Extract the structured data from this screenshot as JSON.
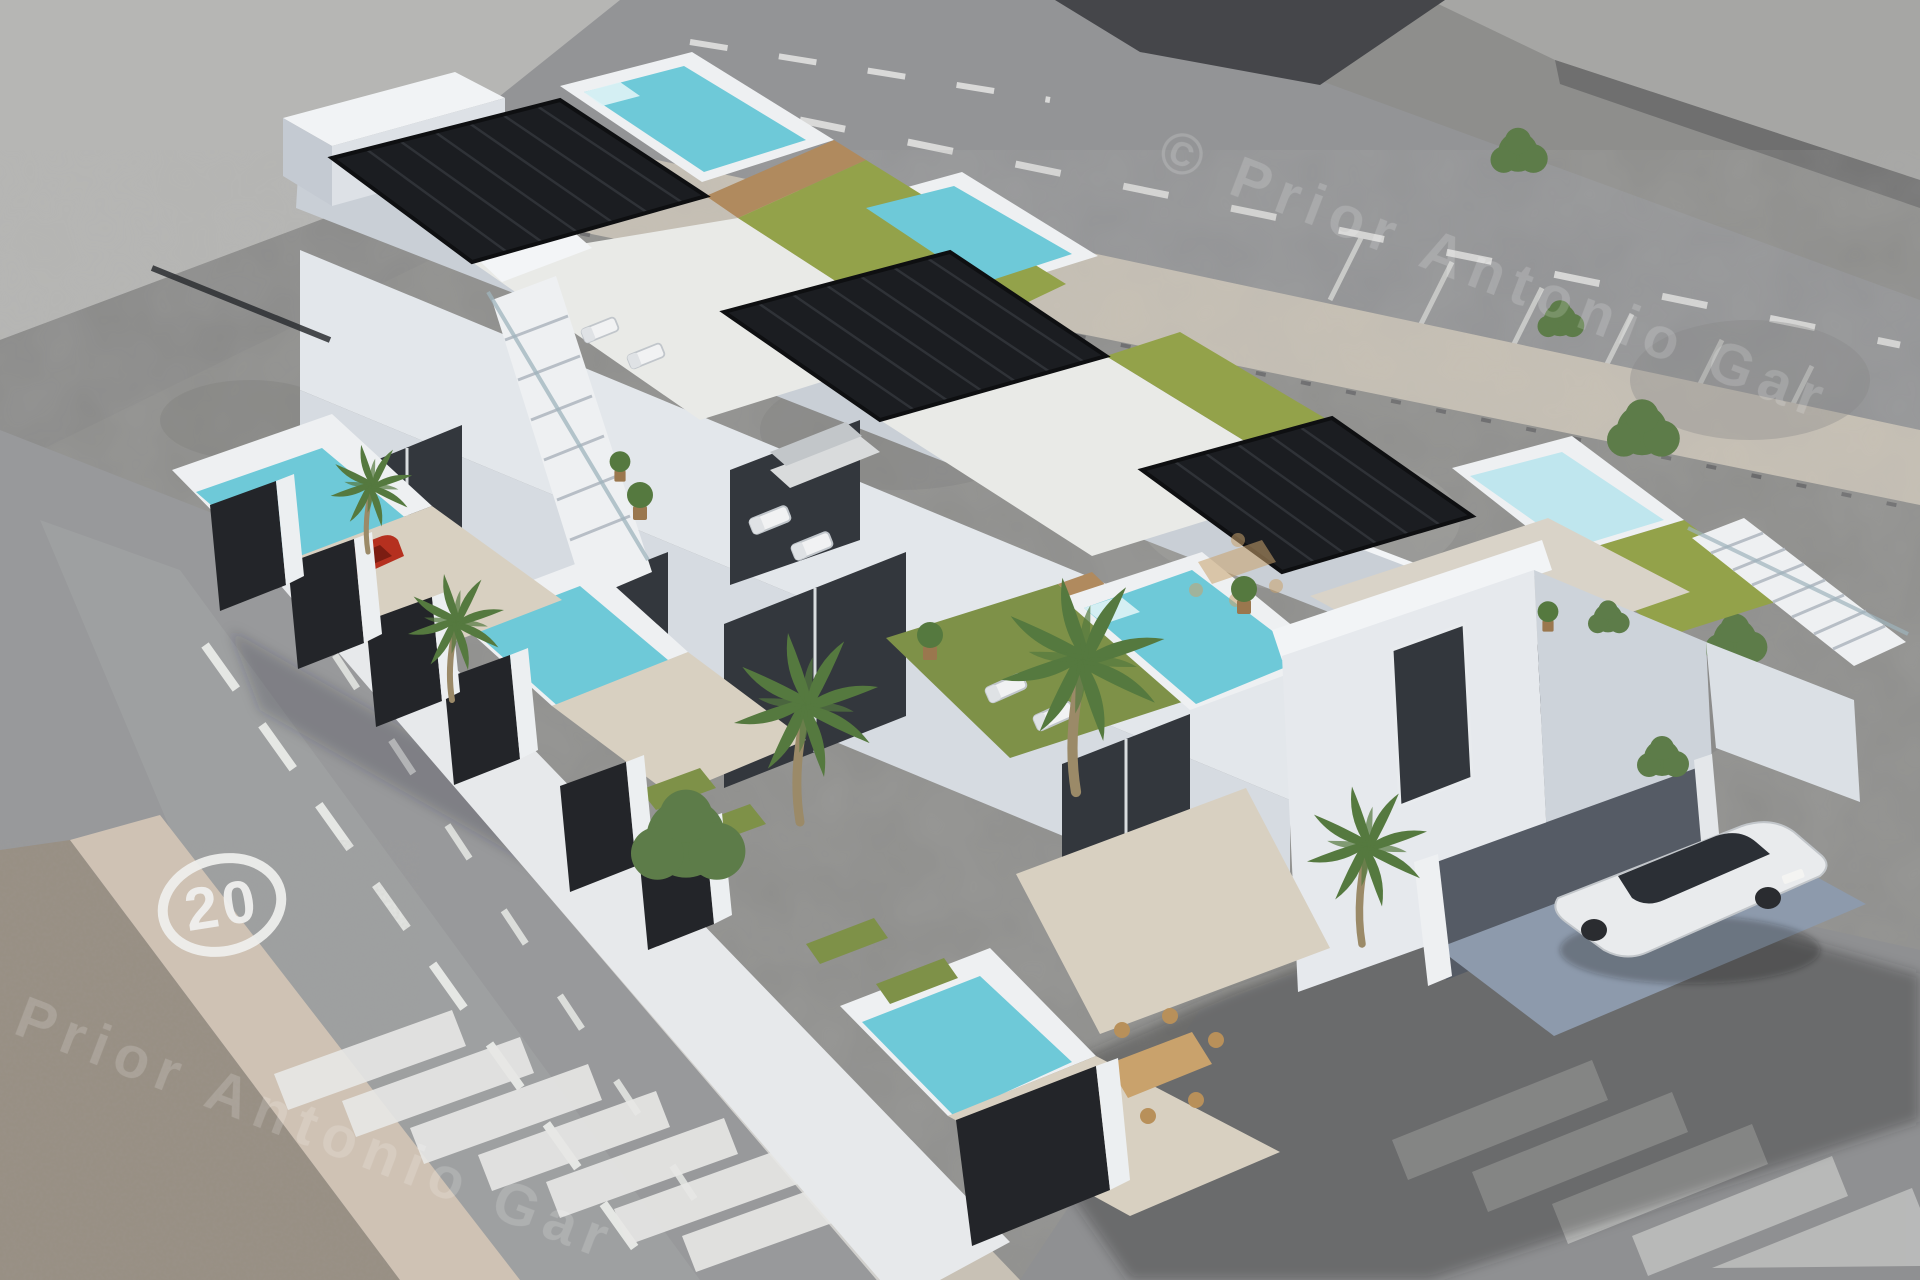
{
  "meta": {
    "description": "Aerial 3D architectural render of a modern white residential row building with black louvered pergolas, rooftop pools, artificial turf roof strips, private garden pools, palm trees, a carport with a white car and a red car behind a black fence, photomontaged onto a grayscale aerial photo of a street corner with lane dashes, pedestrian crossings and a painted 20 km/h speed marking."
  },
  "watermark": {
    "text": "© Prior Antonio Gar",
    "opacity": 0.17
  },
  "road": {
    "speed_limit_marking": "20"
  },
  "palette": {
    "lot_gray": "#8e8e8c",
    "top_road_gray": "#939496",
    "street_gray": "#98999b",
    "sidewalk_beige": "#c8c1b5",
    "rubble_tan": "#988f83",
    "warehouse_gray": "#a6a6a4",
    "dark_roof": "#45464a",
    "building_white": "#eef0f3",
    "building_shade": "#c9cfd6",
    "pergola_black": "#1b1d21",
    "pool_water": "#6ec9d8",
    "pool_pale": "#bfe6ee",
    "roof_turf": "#93a24a",
    "terrace_turf": "#7e9148",
    "gravel_beige": "#d8d0c1",
    "fence_black": "#232529",
    "carport_floor": "#8d9aac",
    "car_white_body": "#e9ebed",
    "car_red_body": "#b5301f",
    "palm_green": "#55793f",
    "glass_dark": "#33373d",
    "cast_shadow": "rgba(38,40,45,0.36)",
    "marking_white": "#f0f0ee"
  }
}
